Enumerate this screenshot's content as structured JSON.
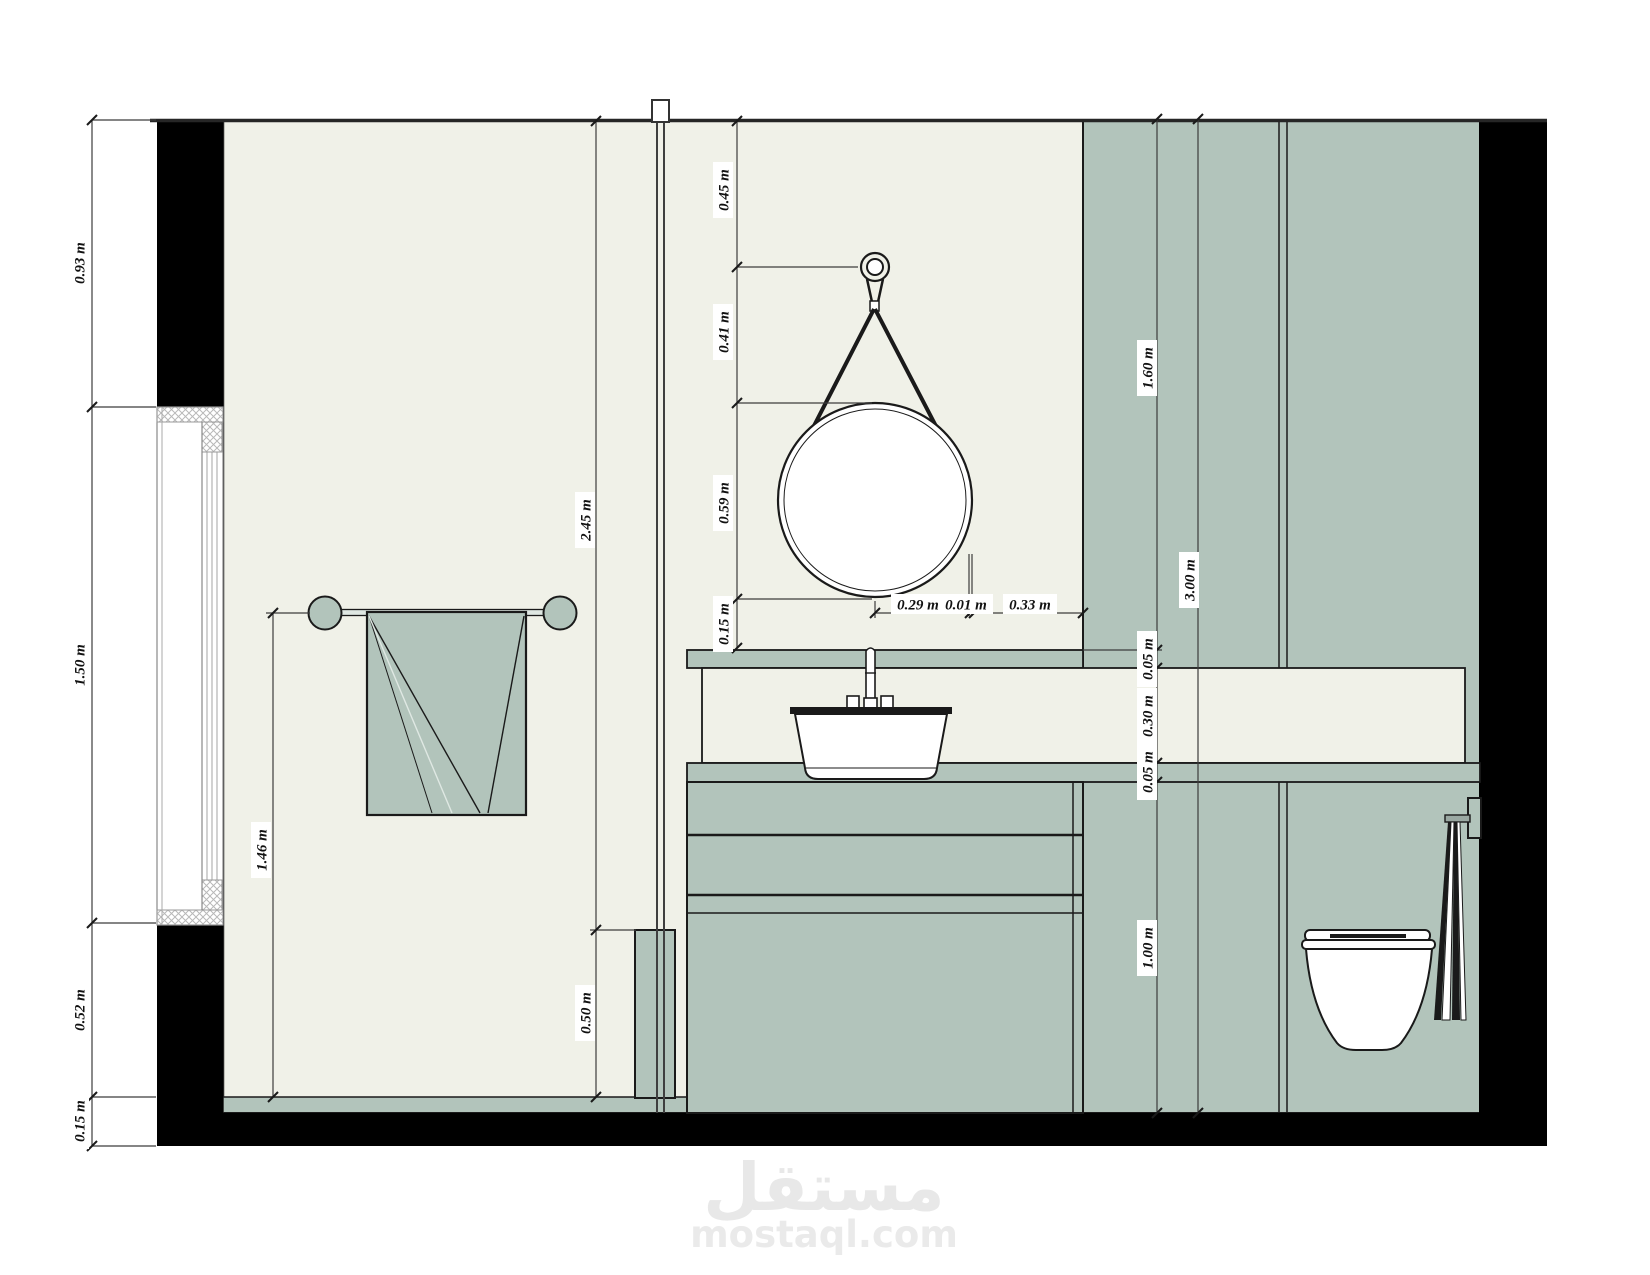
{
  "drawing": {
    "type": "bathroom-interior-elevation",
    "colors": {
      "wall_fill": "#f0f1e8",
      "panel_fill": "#b2c4bb",
      "structure_black": "#000000",
      "outline": "#1a1a1a",
      "watermark_gray": "#e8e8e8"
    }
  },
  "dims": {
    "left": [
      "0.93 m",
      "1.50 m",
      "0.52 m",
      "0.15 m"
    ],
    "shower_height": "2.45 m",
    "half_wall_height": "0.50 m",
    "towel_bar_height": "1.46 m",
    "mirror": [
      "0.45 m",
      "0.41 m",
      "0.59 m",
      "0.15 m"
    ],
    "mirror_h": [
      "0.29 m",
      "0.01 m",
      "0.33 m"
    ],
    "right": [
      "1.60 m",
      "0.05 m",
      "0.30 m",
      "0.05 m",
      "1.00 m"
    ],
    "total_height": "3.00 m"
  },
  "watermark": {
    "logo": "مستقل",
    "domain": "mostaql.com"
  }
}
